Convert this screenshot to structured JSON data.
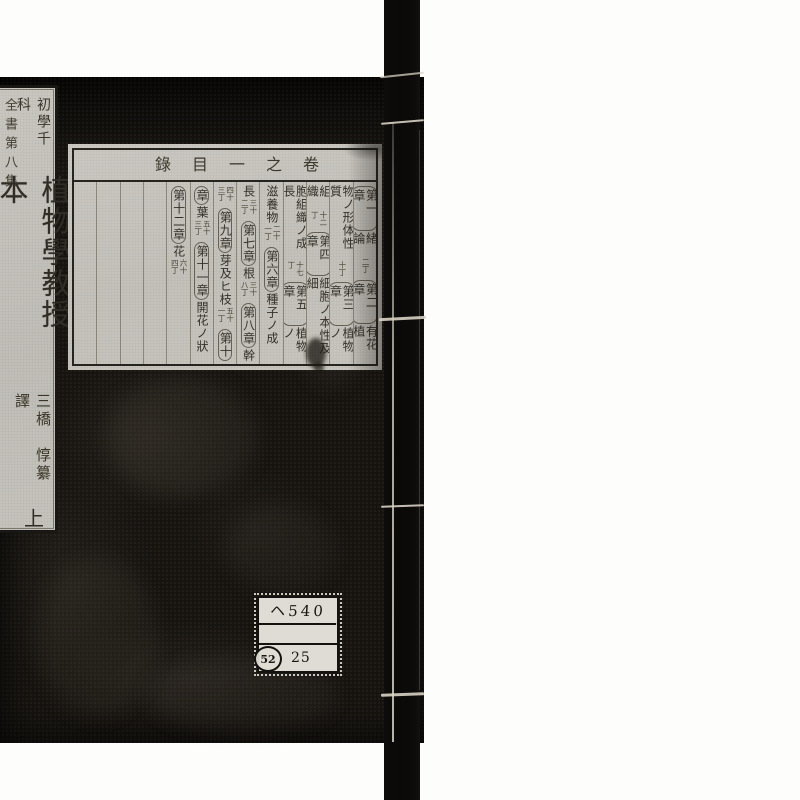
{
  "colors": {
    "background": "#ffffff",
    "cover": "#16130f",
    "spine": "#0a0908",
    "thread": "#d8d2c4",
    "label_paper": "#c8c6bf",
    "ink": "#34302a"
  },
  "title_label": {
    "series_edge": "全書第八集",
    "series_header": "初學千科",
    "title": "植物學教授本",
    "author": "三橋　惇纂譯",
    "volume": "上"
  },
  "toc": {
    "header": "卷之一目錄",
    "columns": [
      {
        "parts": [
          "第一章",
          "緒論",
          "二丁",
          "第二章",
          "有花植"
        ]
      },
      {
        "parts": [
          "物ノ形体性質",
          "十丁",
          "第三章",
          "植物ノ"
        ]
      },
      {
        "parts": [
          "組織",
          "十二丁",
          "第四章",
          "細胞ノ本性及細"
        ]
      },
      {
        "parts": [
          "胞組織ノ成長",
          "十七丁",
          "第五章",
          "植物ノ"
        ]
      },
      {
        "parts": [
          "滋養物",
          "二十一丁",
          "第六章",
          "種子ノ成"
        ]
      },
      {
        "parts": [
          "長",
          "三十二丁",
          "第七章",
          "根",
          "三十八丁",
          "第八章",
          "幹"
        ]
      },
      {
        "parts": [
          "四十三丁",
          "第九章",
          "芽及ヒ枝",
          "五十一丁",
          "第十"
        ]
      },
      {
        "parts": [
          "章",
          "葉",
          "五十三丁",
          "第十一章",
          "開花ノ狀"
        ]
      },
      {
        "parts": [
          "第十二章",
          "花",
          "六十四丁"
        ]
      }
    ],
    "empty_columns": 4
  },
  "sticker": {
    "row1": "ヘ540",
    "row2": "",
    "circle": "52",
    "number": "25"
  }
}
